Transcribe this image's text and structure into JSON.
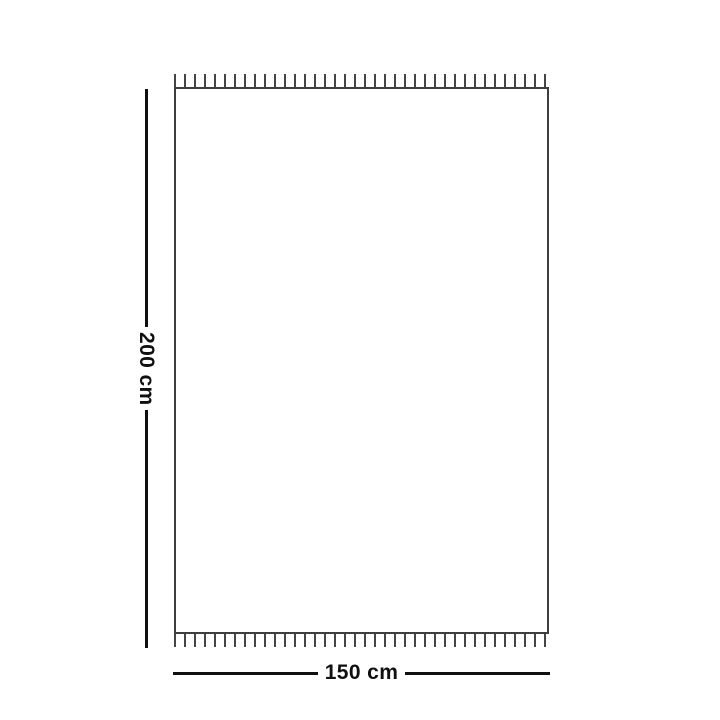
{
  "dimensions": {
    "height_label": "200 cm",
    "width_label": "150 cm"
  },
  "colors": {
    "background": "#ffffff",
    "outline": "#3f3f3f",
    "fringe": "#454545",
    "dimension_line": "#101010",
    "text": "#101010"
  }
}
